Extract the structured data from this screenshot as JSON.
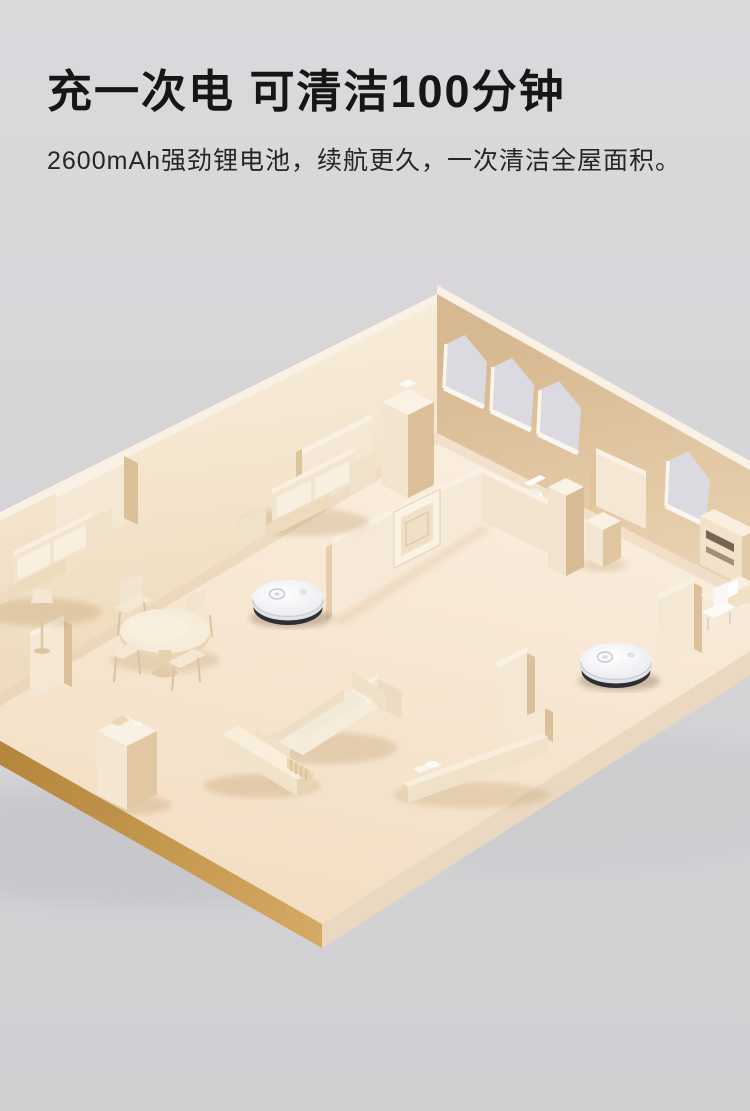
{
  "header": {
    "title": "充一次电 可清洁100分钟",
    "subtitle": "2600mAh强劲锂电池，续航更久，一次清洁全屋面积。"
  },
  "palette": {
    "bg-top": "#dad9dc",
    "bg-bottom": "#d0d0d3",
    "title-color": "#161616",
    "subtitle-color": "#262626",
    "floor": "#f7e9d7",
    "wall-light": "#f4e7d4",
    "wall-shaded": "#d9bc96",
    "wall-top": "#f9f1e4",
    "slab-edge": "#c2944a",
    "window-glass": "#dadae0",
    "robot-body": "#eff1f4",
    "robot-base": "#2f2f33"
  },
  "scene": {
    "type": "isometric-floorplan-3d-render",
    "window_count": 4,
    "robots": [
      {
        "name": "robot-vacuum-1"
      },
      {
        "name": "robot-vacuum-2"
      }
    ],
    "furniture": [
      "sofa",
      "sofa",
      "sofa",
      "dining-table",
      "stools",
      "chairs",
      "tv-console",
      "sideboard",
      "cabinet",
      "tall-cabinet",
      "desk",
      "door",
      "toilet",
      "floor-lamp"
    ]
  }
}
